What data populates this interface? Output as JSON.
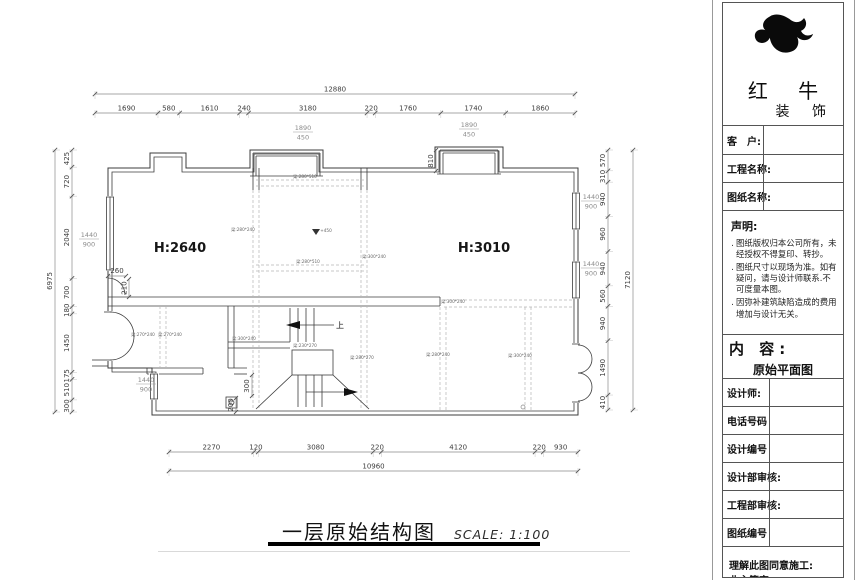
{
  "sidebar": {
    "brand": {
      "line1": "红 牛",
      "line2": "装 饰"
    },
    "client_label": "客　户:",
    "project_label": "工程名称:",
    "drawingname_label": "图纸名称:",
    "statement_title": "声明:",
    "statement_items": [
      "图纸版权归本公司所有，未经授权不得复印、转抄。",
      "图纸尺寸以现场为准。如有疑问，请与设计师联系.不可度量本图。",
      "因弥补建筑缺陷造成的费用增加与设计无关。"
    ],
    "content_label": "内 容:",
    "content_value": "原始平面图",
    "rows": [
      {
        "label": "设计师:"
      },
      {
        "label": "电话号码"
      },
      {
        "label": "设计编号"
      },
      {
        "label": "设计部审核:"
      },
      {
        "label": "工程部审核:"
      },
      {
        "label": "图纸编号"
      }
    ],
    "signoff1": "理解此图同意施工:",
    "signoff2": "业主签字:"
  },
  "footer": {
    "title": "一层原始结构图",
    "scale": "SCALE: 1:100"
  },
  "drawing": {
    "rooms": [
      {
        "label": "H:2640",
        "x": 180,
        "y": 252
      },
      {
        "label": "H:3010",
        "x": 484,
        "y": 252
      }
    ],
    "level_marker": "+450",
    "up_label": "上",
    "chains": {
      "top": {
        "overall": "12880",
        "segments": [
          "1690",
          "580",
          "1610",
          "240",
          "3180",
          "220",
          "1760",
          "1740",
          "1860"
        ]
      },
      "bottom": {
        "overall": "10960",
        "segments": [
          "2270",
          "120",
          "3080",
          "220",
          "4120",
          "220",
          "930"
        ]
      },
      "left": {
        "overall": "6975",
        "segments": [
          "425",
          "720",
          "2040",
          "700",
          "180",
          "1450",
          "175",
          "510",
          "300"
        ]
      },
      "right": {
        "overall": "7120",
        "segments": [
          "570",
          "310",
          "940",
          "960",
          "940",
          "560",
          "940",
          "1490",
          "410"
        ]
      }
    },
    "window_labels": [
      {
        "num": "1440",
        "den": "900",
        "x": 89,
        "y": 237
      },
      {
        "num": "1440",
        "den": "900",
        "x": 146,
        "y": 382
      },
      {
        "num": "1440",
        "den": "900",
        "x": 591,
        "y": 199
      },
      {
        "num": "1440",
        "den": "900",
        "x": 591,
        "y": 266
      },
      {
        "num": "1890",
        "den": "450",
        "x": 303,
        "y": 130
      },
      {
        "num": "1890",
        "den": "450",
        "x": 469,
        "y": 127
      }
    ],
    "misc_dims": [
      {
        "t": "260",
        "x": 117,
        "y": 273,
        "rot": 0
      },
      {
        "t": "210",
        "x": 126.5,
        "y": 288,
        "rot": -90
      },
      {
        "t": "810",
        "x": 433,
        "y": 161,
        "rot": -90
      },
      {
        "t": "300",
        "x": 249,
        "y": 386,
        "rot": -90
      },
      {
        "t": "200",
        "x": 233,
        "y": 405,
        "rot": -90
      }
    ],
    "beam_labels": [
      {
        "t": "梁:280*510",
        "x": 305,
        "y": 178
      },
      {
        "t": "梁:280*240",
        "x": 243,
        "y": 231
      },
      {
        "t": "梁:280*510",
        "x": 308,
        "y": 263
      },
      {
        "t": "梁:300*240",
        "x": 374,
        "y": 258
      },
      {
        "t": "梁:300*240",
        "x": 453,
        "y": 303
      },
      {
        "t": "梁:300*240",
        "x": 244,
        "y": 340
      },
      {
        "t": "梁:230*270",
        "x": 305,
        "y": 347
      },
      {
        "t": "梁:280*270",
        "x": 362,
        "y": 359
      },
      {
        "t": "梁:280*240",
        "x": 438,
        "y": 356
      },
      {
        "t": "梁:300*240",
        "x": 520,
        "y": 357
      },
      {
        "t": "梁:270*240",
        "x": 143,
        "y": 336
      },
      {
        "t": "梁:270*240",
        "x": 170,
        "y": 336
      }
    ]
  }
}
